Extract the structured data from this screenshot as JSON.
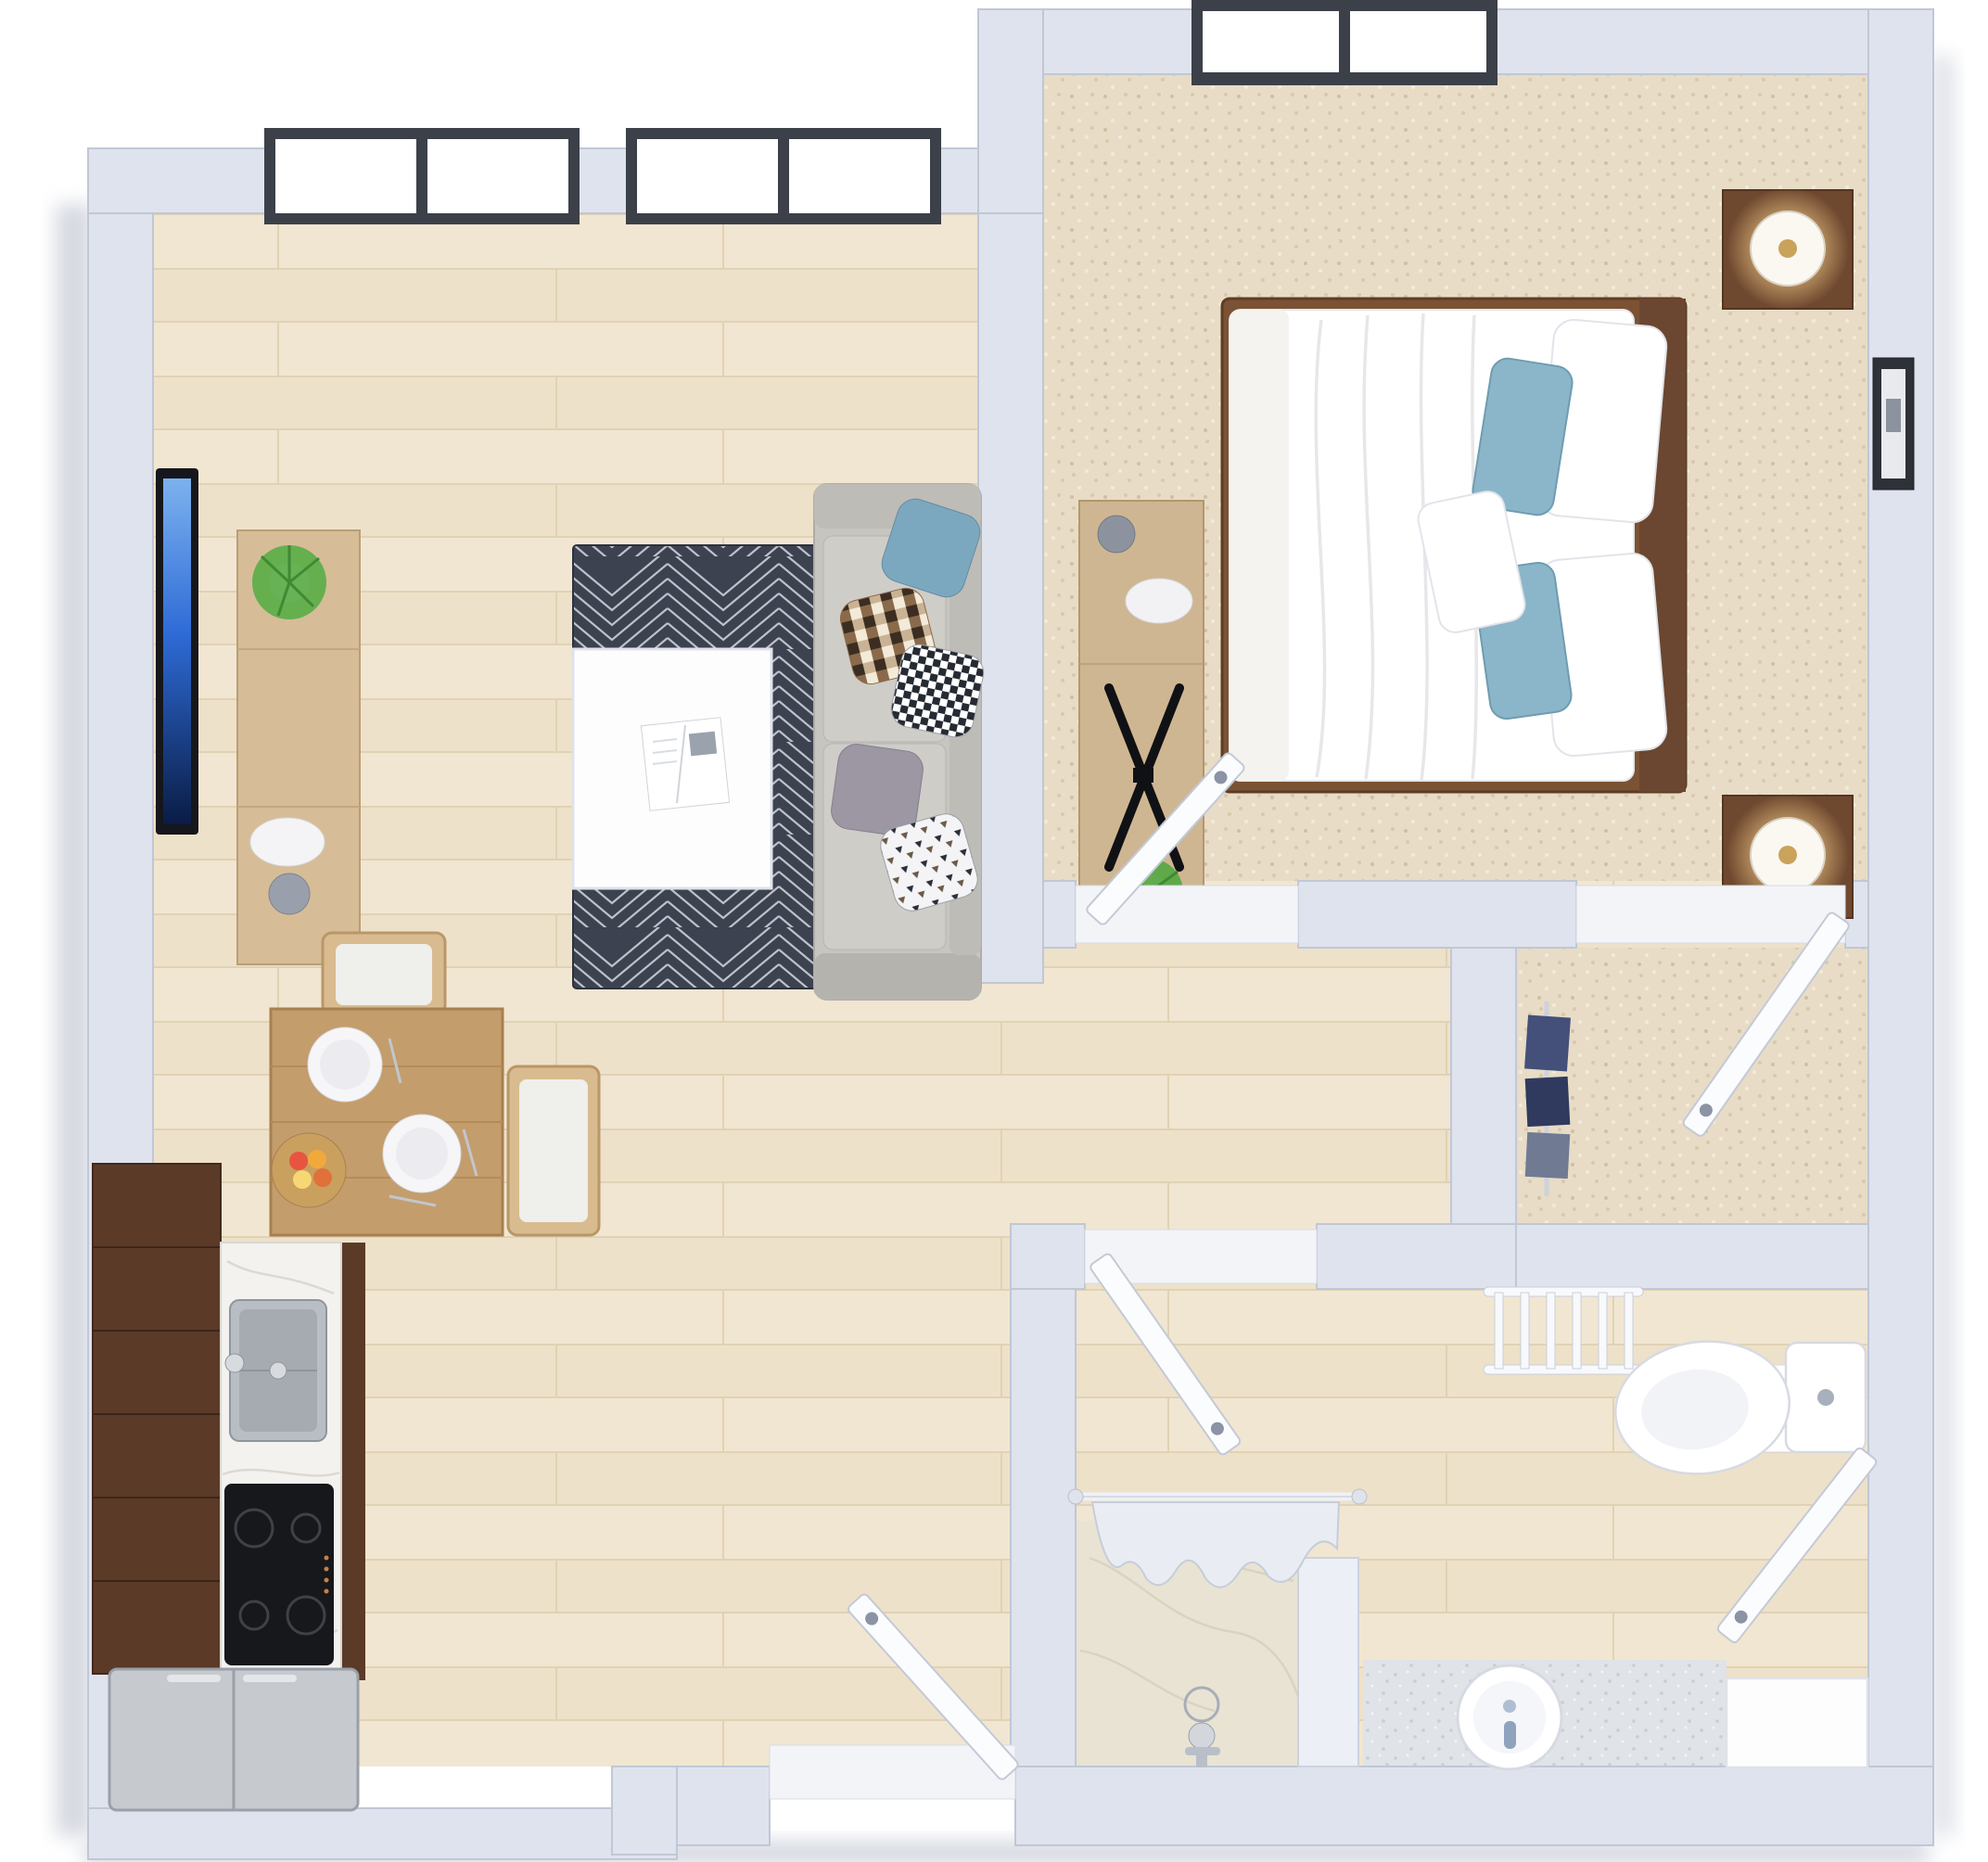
{
  "meta": {
    "title": "3D rendered floor plan of a one-bedroom apartment, top-down view",
    "style": "photoreal 3D dollhouse render, no text labels"
  },
  "palette": {
    "background": "#ffffff",
    "wall": "#dfe3ed",
    "wall_edge": "#c0c7d6",
    "wood_floor": "#f1e6d1",
    "carpet": "#e8dcc6",
    "rug_dark": "#3d4250",
    "rug_lines": "#dfe3ea",
    "sofa_gray": "#c7c5c0",
    "cabinet_dark_wood": "#5b3a28",
    "dining_wood": "#c49d6d",
    "console_wood": "#d6bd97",
    "bedroom_wood_dark": "#6f4830",
    "accent_blue_pillow": "#8bb6c9",
    "window_frame": "#3c4049",
    "lamp_glow": "#ffd98f",
    "marble": "#e9e3d3",
    "terrazzo": "#e0e3e7",
    "stainless": "#c6cacf",
    "tv_screen_blue": "#2e6bd6"
  },
  "rooms": [
    {
      "id": "living-room",
      "label": "Living room",
      "floor": "light wood planks",
      "furniture": [
        "wall mounted TV",
        "wood TV console",
        "potted plant",
        "plate and vase decor",
        "dark geometric area rug",
        "white square coffee table",
        "open magazine",
        "gray sectional sofa",
        "five throw pillows (blue, brown checker, bw checker, gray, triangle print)"
      ],
      "windows": "two large black-framed windows on top wall"
    },
    {
      "id": "dining-area",
      "label": "Dining area",
      "floor": "light wood planks",
      "furniture": [
        "square wood dining table",
        "two wood chairs with white cushions",
        "two place settings with plates and cutlery",
        "bowl of fruit"
      ]
    },
    {
      "id": "kitchen",
      "label": "Kitchen",
      "floor": "light wood planks",
      "furniture": [
        "dark walnut cabinet run",
        "white marble countertop",
        "stainless double sink with faucet",
        "black 4-burner cooktop",
        "stainless refrigerator in corner"
      ]
    },
    {
      "id": "bedroom",
      "label": "Bedroom",
      "floor": "beige carpet",
      "furniture": [
        "double bed with white duvet",
        "two white pillows",
        "two blue accent pillows",
        "small white throw pillow",
        "dark wood bed frame and headboard",
        "two dark wood nightstands",
        "two lit table lamps",
        "light wood dresser console",
        "flat screen TV with X stand",
        "potted plant",
        "vase and plate decor",
        "framed wall art on right wall"
      ],
      "windows": "one black-framed window on top wall"
    },
    {
      "id": "walk-in-closet",
      "label": "Walk-in closet",
      "floor": "beige carpet",
      "furniture": [
        "hanging clothes on rod"
      ]
    },
    {
      "id": "bathroom",
      "label": "Bathroom",
      "floor": "light wood planks",
      "furniture": [
        "walk-in shower with marble floor",
        "white shower curtain on rod",
        "chrome shower fixture and drain",
        "white toilet with tank against right wall",
        "terrazzo vanity counter with round white sink",
        "blue-gray faucet",
        "white towel ladder rack",
        "white storage cabinet"
      ]
    },
    {
      "id": "entry",
      "label": "Entry",
      "floor": "light wood planks",
      "furniture": []
    },
    {
      "id": "hallway",
      "label": "Hallway",
      "floor": "light wood planks",
      "furniture": []
    }
  ],
  "openings": {
    "windows": [
      {
        "id": "living-window-1",
        "wall": "top",
        "panes": 2
      },
      {
        "id": "living-window-2",
        "wall": "top",
        "panes": 2
      },
      {
        "id": "bedroom-window",
        "wall": "top",
        "panes": 2
      }
    ],
    "doors": [
      {
        "id": "entry-door",
        "type": "hinged, shown open",
        "location": "bottom wall"
      },
      {
        "id": "bedroom-door",
        "type": "hinged, shown open",
        "location": "bedroom lower wall"
      },
      {
        "id": "closet-door",
        "type": "hinged, shown open",
        "location": "closet upper wall"
      },
      {
        "id": "bathroom-door",
        "type": "hinged, shown open",
        "location": "end of hallway"
      },
      {
        "id": "bathroom-storage-door",
        "type": "hinged, shown open",
        "location": "bathroom right wall"
      }
    ]
  }
}
